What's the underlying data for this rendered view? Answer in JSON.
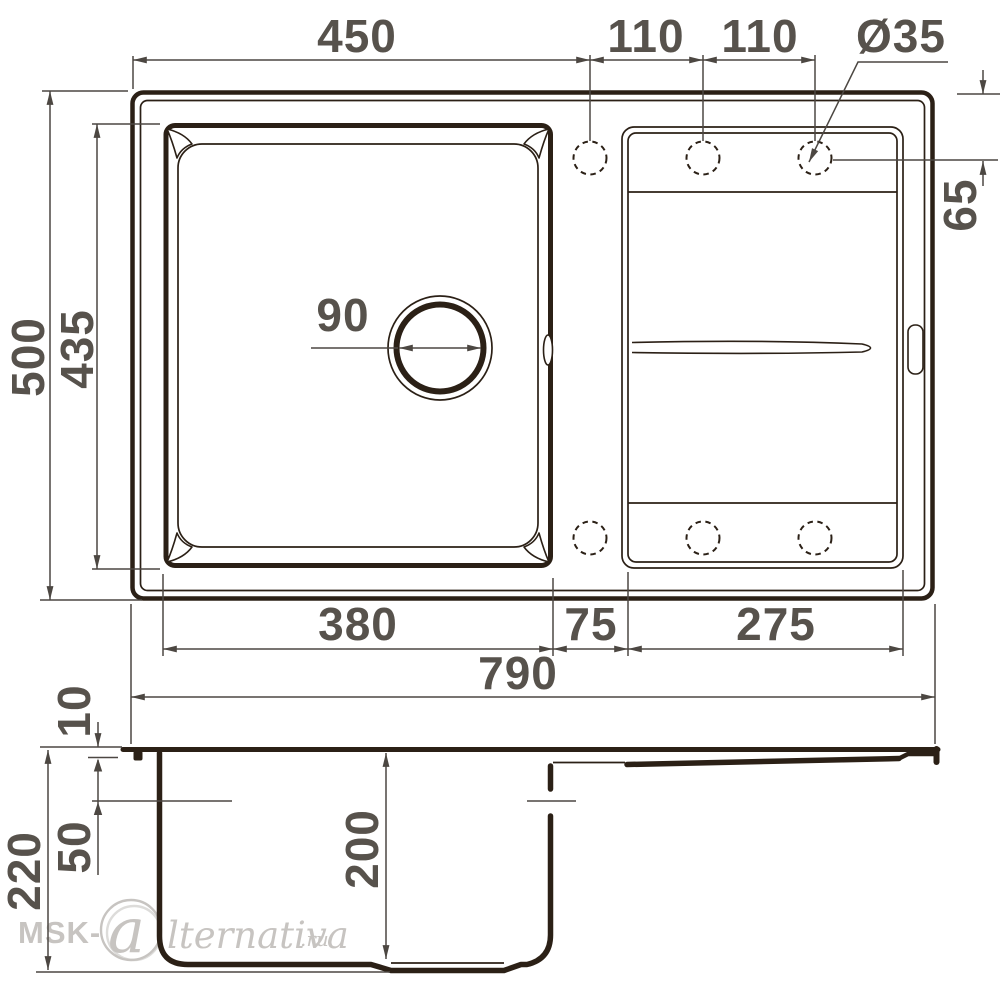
{
  "top_view": {
    "width_to_hole1": "450",
    "hole_pitch_a": "110",
    "hole_pitch_b": "110",
    "hole_diameter": "Ø35",
    "hole_edge_offset": "65",
    "overall_depth": "500",
    "bowl_length": "435",
    "drain_diameter": "90",
    "bowl_width": "380",
    "bowl_drainboard_gap": "75",
    "drainboard_width": "275",
    "overall_width": "790"
  },
  "side_view": {
    "rim_height": "10",
    "overflow_offset": "50",
    "overall_height": "220",
    "bowl_depth": "200"
  },
  "watermark": {
    "prefix": "MSK-",
    "monogram": "a",
    "name": "lternativa",
    "tld": ".ru"
  },
  "colors": {
    "line_dark": "#2b2016",
    "dim_line": "#4c4742",
    "dim_text": "#57524c",
    "watermark": "#c7c4c1",
    "background": "#ffffff"
  }
}
